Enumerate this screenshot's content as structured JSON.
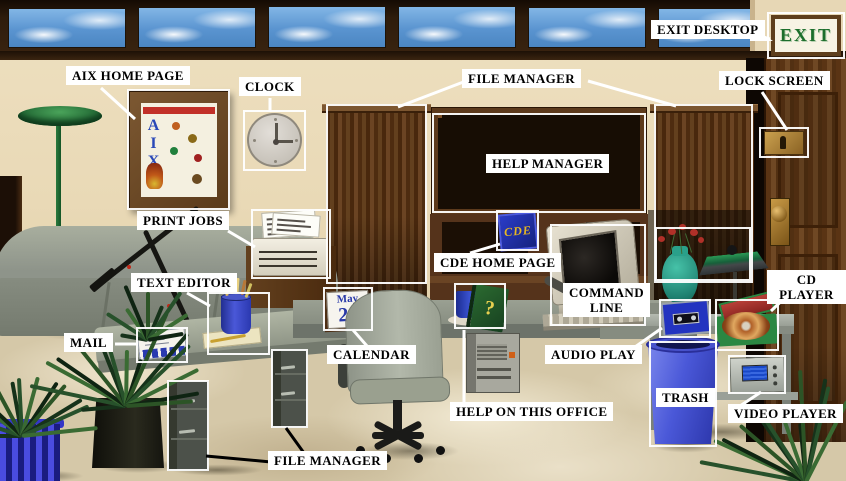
{
  "labels": [
    {
      "id": "aix-home-page",
      "text": "AIX HOME PAGE",
      "x": 66,
      "y": 66
    },
    {
      "id": "clock",
      "text": "CLOCK",
      "x": 239,
      "y": 77
    },
    {
      "id": "file-manager-top",
      "text": "FILE MANAGER",
      "x": 462,
      "y": 69
    },
    {
      "id": "exit-desktop",
      "text": "EXIT DESKTOP",
      "x": 651,
      "y": 20
    },
    {
      "id": "lock-screen",
      "text": "LOCK SCREEN",
      "x": 719,
      "y": 71
    },
    {
      "id": "help-manager",
      "text": "HELP MANAGER",
      "x": 486,
      "y": 154
    },
    {
      "id": "print-jobs",
      "text": "PRINT JOBS",
      "x": 137,
      "y": 211
    },
    {
      "id": "cde-home-page",
      "text": "CDE HOME PAGE",
      "x": 434,
      "y": 253
    },
    {
      "id": "text-editor",
      "text": "TEXT EDITOR",
      "x": 131,
      "y": 273
    },
    {
      "id": "command-line",
      "text": "COMMAND\nLINE",
      "x": 563,
      "y": 283
    },
    {
      "id": "mail",
      "text": "MAIL",
      "x": 64,
      "y": 333
    },
    {
      "id": "calendar",
      "text": "CALENDAR",
      "x": 327,
      "y": 345
    },
    {
      "id": "audio-play",
      "text": "AUDIO PLAY",
      "x": 545,
      "y": 345
    },
    {
      "id": "help-on-this-office",
      "text": "HELP ON THIS OFFICE",
      "x": 450,
      "y": 402
    },
    {
      "id": "trash",
      "text": "TRASH",
      "x": 656,
      "y": 388
    },
    {
      "id": "cd-player",
      "text": "CD PLAYER",
      "x": 767,
      "y": 270
    },
    {
      "id": "video-player",
      "text": "VIDEO PLAYER",
      "x": 728,
      "y": 404
    },
    {
      "id": "file-manager-bottom",
      "text": "FILE MANAGER",
      "x": 268,
      "y": 451
    }
  ],
  "connectors": [
    {
      "x1": 101,
      "y1": 88,
      "x2": 135,
      "y2": 119,
      "c": "#ffffff"
    },
    {
      "x1": 270,
      "y1": 98,
      "x2": 270,
      "y2": 112,
      "c": "#ffffff"
    },
    {
      "x1": 466,
      "y1": 81,
      "x2": 398,
      "y2": 107,
      "c": "#ffffff"
    },
    {
      "x1": 588,
      "y1": 81,
      "x2": 676,
      "y2": 106,
      "c": "#ffffff"
    },
    {
      "x1": 749,
      "y1": 33,
      "x2": 770,
      "y2": 39,
      "c": "#ffffff"
    },
    {
      "x1": 762,
      "y1": 92,
      "x2": 787,
      "y2": 130,
      "c": "#ffffff"
    },
    {
      "x1": 228,
      "y1": 231,
      "x2": 255,
      "y2": 247,
      "c": "#ffffff"
    },
    {
      "x1": 470,
      "y1": 253,
      "x2": 500,
      "y2": 244,
      "c": "#ffffff"
    },
    {
      "x1": 187,
      "y1": 293,
      "x2": 210,
      "y2": 306,
      "c": "#ffffff"
    },
    {
      "x1": 115,
      "y1": 344,
      "x2": 138,
      "y2": 344,
      "c": "#ffffff"
    },
    {
      "x1": 353,
      "y1": 330,
      "x2": 367,
      "y2": 346,
      "c": "#ffffff"
    },
    {
      "x1": 632,
      "y1": 349,
      "x2": 662,
      "y2": 328,
      "c": "#ffffff"
    },
    {
      "x1": 464,
      "y1": 402,
      "x2": 464,
      "y2": 330,
      "c": "#ffffff"
    },
    {
      "x1": 793,
      "y1": 290,
      "x2": 771,
      "y2": 311,
      "c": "#ffffff"
    },
    {
      "x1": 737,
      "y1": 408,
      "x2": 761,
      "y2": 392,
      "c": "#ffffff"
    },
    {
      "x1": 271,
      "y1": 462,
      "x2": 206,
      "y2": 456,
      "c": "#000000"
    },
    {
      "x1": 286,
      "y1": 428,
      "x2": 304,
      "y2": 453,
      "c": "#000000"
    }
  ],
  "hotspots": [
    {
      "id": "aix-poster",
      "x": 127,
      "y": 89,
      "w": 103,
      "h": 121
    },
    {
      "id": "clock",
      "x": 243,
      "y": 110,
      "w": 63,
      "h": 61
    },
    {
      "id": "cabinet-left",
      "x": 326,
      "y": 104,
      "w": 101,
      "h": 180
    },
    {
      "id": "bookshelf",
      "x": 432,
      "y": 113,
      "w": 214,
      "h": 100
    },
    {
      "id": "cabinet-right",
      "x": 654,
      "y": 104,
      "w": 99,
      "h": 179
    },
    {
      "id": "door-lock",
      "x": 759,
      "y": 127,
      "w": 50,
      "h": 31
    },
    {
      "id": "exit-sign",
      "x": 767,
      "y": 12,
      "w": 78,
      "h": 47
    },
    {
      "id": "printer",
      "x": 251,
      "y": 209,
      "w": 80,
      "h": 70
    },
    {
      "id": "pencil-cup",
      "x": 207,
      "y": 292,
      "w": 63,
      "h": 63
    },
    {
      "id": "envelope",
      "x": 136,
      "y": 327,
      "w": 52,
      "h": 36
    },
    {
      "id": "desk-calendar",
      "x": 323,
      "y": 287,
      "w": 50,
      "h": 44
    },
    {
      "id": "cde-icon",
      "x": 496,
      "y": 210,
      "w": 43,
      "h": 41
    },
    {
      "id": "help-book",
      "x": 454,
      "y": 283,
      "w": 52,
      "h": 46
    },
    {
      "id": "monitor",
      "x": 550,
      "y": 224,
      "w": 96,
      "h": 102
    },
    {
      "id": "flower-vase",
      "x": 655,
      "y": 227,
      "w": 96,
      "h": 54
    },
    {
      "id": "cassette",
      "x": 659,
      "y": 299,
      "w": 52,
      "h": 39
    },
    {
      "id": "cd",
      "x": 715,
      "y": 299,
      "w": 64,
      "h": 52
    },
    {
      "id": "video-player",
      "x": 728,
      "y": 355,
      "w": 58,
      "h": 39
    },
    {
      "id": "trash-can",
      "x": 649,
      "y": 341,
      "w": 68,
      "h": 106
    },
    {
      "id": "drawer-left",
      "x": 167,
      "y": 380,
      "w": 42,
      "h": 91
    },
    {
      "id": "drawer-center",
      "x": 271,
      "y": 349,
      "w": 37,
      "h": 79
    }
  ],
  "objects": {
    "exit_sign": {
      "text": "EXIT"
    },
    "poster": {
      "title": "AIX"
    },
    "desk_calendar": {
      "month": "May",
      "day": "24"
    },
    "cde_icon": {
      "text": "CDE"
    },
    "help_book": {
      "glyph": "?"
    },
    "clock": {
      "time": "3:00"
    }
  },
  "book_palette": [
    "#a62820",
    "#203c9c",
    "#1e7c36",
    "#d2b62a",
    "#6e1414",
    "#d8d5c8",
    "#58289a",
    "#c05818",
    "#104a78",
    "#8a1a1e",
    "#2a8a8a"
  ]
}
